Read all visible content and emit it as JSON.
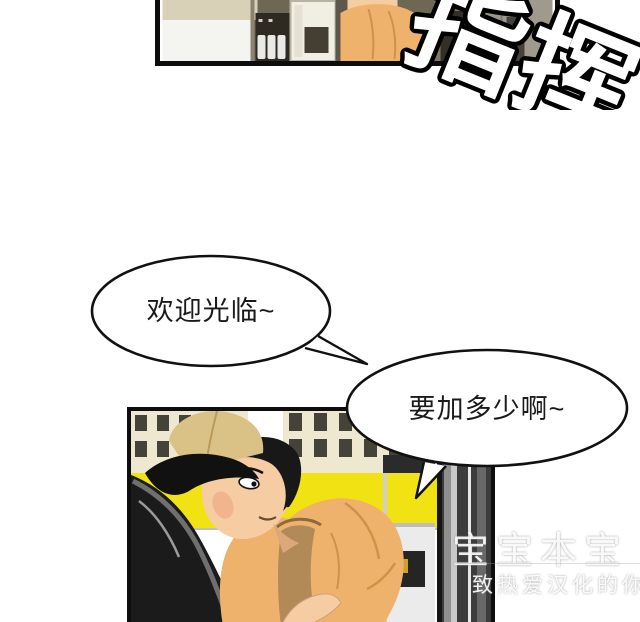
{
  "page": {
    "kind": "comic-page",
    "background": "#ffffff"
  },
  "sfx": {
    "text": "指挥",
    "fill": "#ffffff",
    "stroke": "#000000"
  },
  "dialogue": {
    "bubble1": "欢迎光临~",
    "bubble2": "要加多少啊~"
  },
  "watermark": {
    "line1": "宝宝本宝",
    "line2": "致热爱汉化的你"
  },
  "colors": {
    "panel_border": "#0d0d0d",
    "canopy_yellow": "#f1e214",
    "shirt_orange": "#eeb26c",
    "cap_khaki": "#dac286",
    "skin": "#f6cda2",
    "building_cream": "#efe8d0",
    "car_black": "#1b1b1b",
    "pump_gray": "#3c3c3c"
  }
}
